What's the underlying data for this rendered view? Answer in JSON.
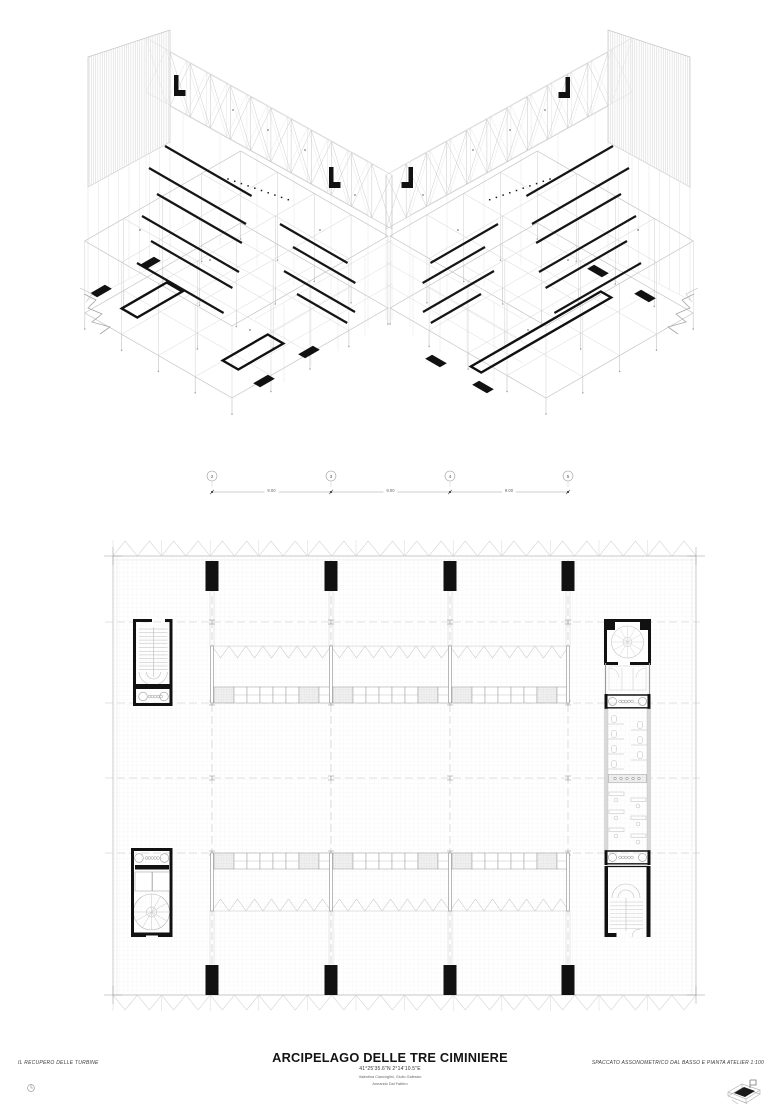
{
  "titleblock": {
    "left_label": "IL RECUPERO DELLE TURBINE",
    "title": "ARCIPELAGO DELLE TRE CIMINIERE",
    "coordinates": "41°25'35.6\"N 2°14'10.5\"E",
    "authors_line1": "Valentina Ciancoglini, Giulio Galessio",
    "authors_line2": "Armando Dal Fabbro",
    "right_label": "SPACCATO ASSONOMETRICO DAL BASSO E PIANTA ATELIER 1:100"
  },
  "grid_strip": {
    "bubbles": [
      "2",
      "3",
      "4",
      "5"
    ],
    "dimensions": [
      "9.00",
      "9.00",
      "9.00"
    ]
  },
  "icons": {
    "north": "north-arrow-icon",
    "locator": "axonometric-key-icon"
  },
  "colors": {
    "ink": "#111111",
    "light_line": "#c9c9c9",
    "grid_line": "#ececec",
    "paper": "#ffffff"
  }
}
